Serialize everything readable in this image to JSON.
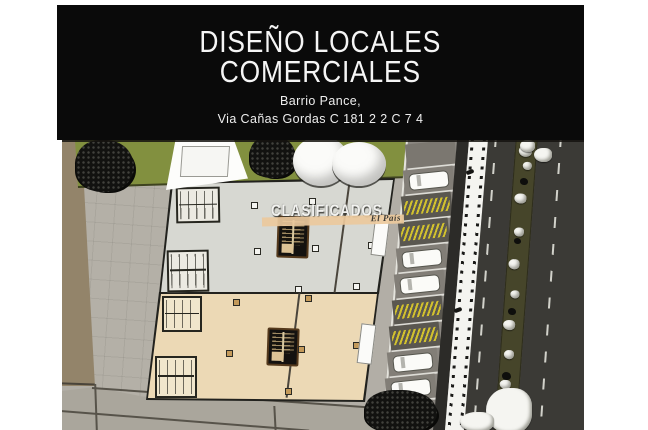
{
  "header": {
    "title_line1": "DISEÑO LOCALES",
    "title_line2": "COMERCIALES",
    "subtitle_line1": "Barrio Pance,",
    "subtitle_line2": "Via Cañas Gordas C 181 2 2 C 7 4",
    "background": "#0a0a0a",
    "text_color": "#f5f5f5"
  },
  "watermark": {
    "text": "CLASIFICADOS",
    "source_label": "El País",
    "bar_color": "#ecc99c"
  },
  "site_plan": {
    "type": "architectural-aerial-render",
    "description": "Top view render of two commercial building floor plans with grass strip, event tent, trees, parking lane, pedestrian walkway, road and planted median with rocks",
    "palette": {
      "pavement": "#b2aea6",
      "tan_path": "#93846a",
      "grass": "#82903f",
      "building_a_floor": "#d7d8d2",
      "building_b_floor": "#ecd9b5",
      "building_outline": "#22221e",
      "parking_lane": "#8b8781",
      "no_parking_hatch": "#d2c22e",
      "walkway": "#f4f4f0",
      "road": "#3b3a36",
      "median_planting": "#46452a",
      "rock": "#f5f5f1"
    },
    "counts": {
      "buildings": 2,
      "parking_stalls": 11,
      "parked_cars": 5,
      "hatched_no_parking_stalls": 4,
      "black_trees": 3,
      "white_shrubs": 1,
      "stair_cores": 2,
      "restroom_blocks": 4
    }
  }
}
